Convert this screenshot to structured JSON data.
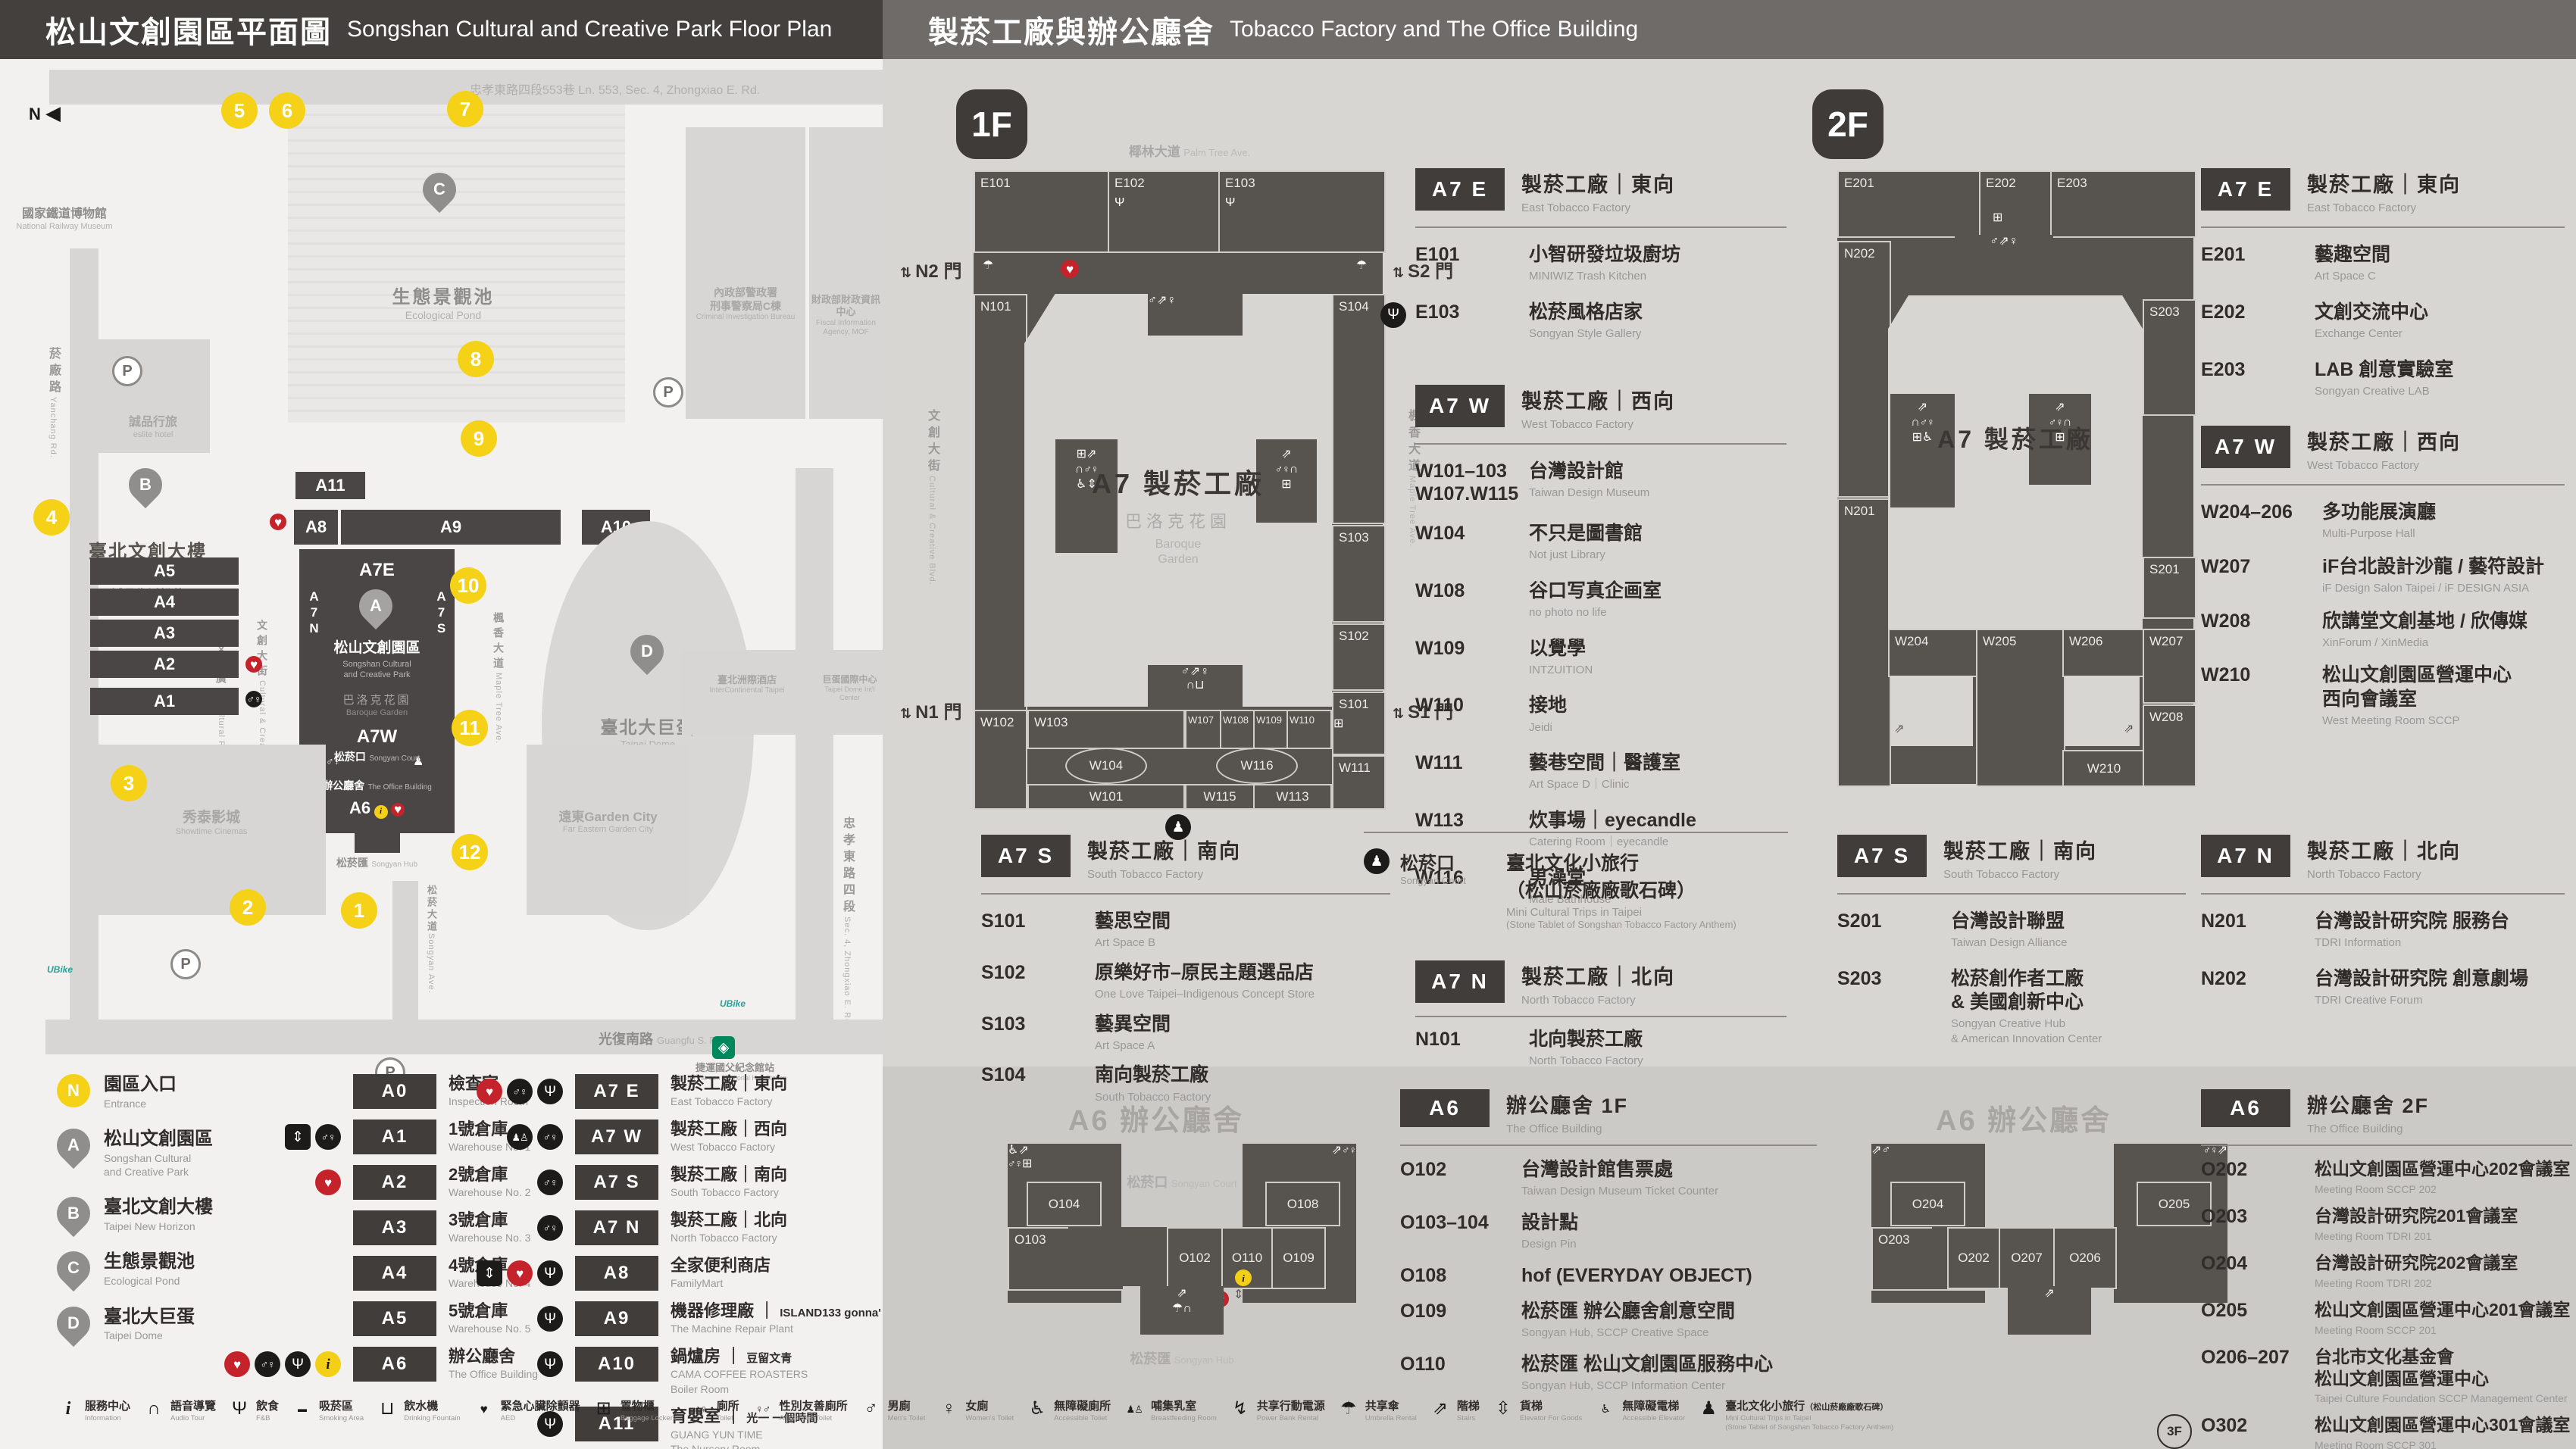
{
  "header": {
    "left_zh": "松山文創園區平面圖",
    "left_en": "Songshan Cultural and Creative Park Floor Plan",
    "right_zh": "製菸工廠與辦公廳舍",
    "right_en": "Tobacco Factory and The Office Building"
  },
  "park": {
    "compass": "N",
    "parking": "P",
    "ubike": "UBike",
    "numbers": [
      "1",
      "2",
      "3",
      "4",
      "5",
      "6",
      "7",
      "8",
      "9",
      "10",
      "11",
      "12"
    ],
    "streets": {
      "top": "忠孝東路四段553巷 Ln. 553, Sec. 4, Zhongxiao E. Rd.",
      "yanchang_zh": "菸廠路",
      "yanchang_en": "Yanchang Rd.",
      "zhongxiao_zh": "忠孝東路四段",
      "zhongxiao_en": "Sec. 4, Zhongxiao E. Rd.",
      "guangfu_zh": "光復南路",
      "guangfu_en": "Guangfu S. Rd.",
      "songyan_zh": "松菸大道",
      "songyan_en": "Songyan Ave.",
      "palm_zh": "椰林大道",
      "palm_en": "Palm Tree Ave.",
      "maple_zh": "楓香大道",
      "maple_en": "Maple Tree Ave.",
      "blvd_zh": "文創大街",
      "blvd_en": "Cultural & Creative Blvd.",
      "plaza_zh": "文化廣場",
      "plaza_en": "Cultural Plaza"
    },
    "landmarks": {
      "railway_zh": "國家鐵道博物館",
      "railway_en": "National Railway Museum",
      "eslite_hotel_zh": "誠品行旅",
      "eslite_hotel_en": "eslite hotel",
      "cib_zh": "內政部警政署",
      "cib_zh2": "刑事警察局C棟",
      "cib_en": "Criminal Investigation Bureau",
      "fia_zh": "財政部財政資訊中心",
      "fia_en": "Fiscal Information Agency, MOF",
      "icc_zh": "臺北洲際酒店",
      "icc_en": "InterContinental Taipei",
      "domeintl_zh": "巨蛋國際中心",
      "domeintl_en": "Taipei Dome Int'l Center",
      "showtime_zh": "秀泰影城",
      "showtime_en": "Showtime Cinemas",
      "garden_zh": "遠東Garden City",
      "garden_en": "Far Eastern Garden City",
      "mrt_zh": "捷運國父紀念館站",
      "mrt_en": "Sun Yat-sen Memorial Hall Station",
      "eslite_spectrum_zh": "誠品生活松菸",
      "eslite_spectrum_en": "eslite Spectrum Songyan",
      "baroque_zh": "巴洛克花園",
      "baroque_en": "Baroque Garden",
      "court_zh": "松菸口",
      "court_en": "Songyan Court",
      "office_zh": "辦公廳舍",
      "office_en": "The Office Building",
      "hub_zh": "松菸匯",
      "hub_en": "Songyan Hub"
    },
    "pins": {
      "a_zh": "松山文創園區",
      "a_en1": "Songshan Cultural",
      "a_en2": "and Creative Park",
      "b_zh": "臺北文創大樓",
      "b_en": "Taipei New Horizon",
      "c_zh": "生態景觀池",
      "c_en": "Ecological Pond",
      "d_zh": "臺北大巨蛋",
      "d_en": "Taipei Dome",
      "a": "A",
      "b": "B",
      "c": "C",
      "d": "D"
    },
    "bars": {
      "a0": "A0",
      "a1": "A1",
      "a2": "A2",
      "a3": "A3",
      "a4": "A4",
      "a5": "A5",
      "a6": "A6",
      "a8": "A8",
      "a9": "A9",
      "a10": "A10",
      "a11": "A11",
      "a7e": "A7E",
      "a7w": "A7W",
      "a7n": "A7N",
      "a7s": "A7S"
    }
  },
  "legend": {
    "pins": [
      {
        "sym": "N",
        "tone": "yellow",
        "zh": "園區入口",
        "en": "Entrance"
      },
      {
        "sym": "A",
        "tone": "gray",
        "zh": "松山文創園區",
        "en": "Songshan Cultural",
        "en2": "and Creative Park"
      },
      {
        "sym": "B",
        "tone": "gray",
        "zh": "臺北文創大樓",
        "en": "Taipei New Horizon"
      },
      {
        "sym": "C",
        "tone": "gray",
        "zh": "生態景觀池",
        "en": "Ecological Pond"
      },
      {
        "sym": "D",
        "tone": "gray",
        "zh": "臺北大巨蛋",
        "en": "Taipei Dome"
      }
    ],
    "col1": [
      {
        "code": "A0",
        "zh": "檢查室",
        "en": "Inspection Room"
      },
      {
        "code": "A1",
        "zh": "1號倉庫",
        "en": "Warehouse No. 1",
        "i1": "elevator",
        "i2": "toilet"
      },
      {
        "code": "A2",
        "zh": "2號倉庫",
        "en": "Warehouse No. 2",
        "i1": "aed"
      },
      {
        "code": "A3",
        "zh": "3號倉庫",
        "en": "Warehouse No. 3"
      },
      {
        "code": "A4",
        "zh": "4號倉庫",
        "en": "Warehouse No. 4"
      },
      {
        "code": "A5",
        "zh": "5號倉庫",
        "en": "Warehouse No. 5"
      },
      {
        "code": "A6",
        "zh": "辦公廳舍",
        "en": "The Office Building",
        "i1": "aed",
        "i2": "toilet",
        "i3": "restaurant",
        "i4": "info"
      }
    ],
    "col2": [
      {
        "code": "A7 E",
        "zh": "製菸工廠｜東向",
        "en": "East Tobacco Factory",
        "i1": "aed",
        "i2": "toilet",
        "i3": "restaurant"
      },
      {
        "code": "A7 W",
        "zh": "製菸工廠｜西向",
        "en": "West Tobacco Factory",
        "i1": "nursing",
        "i2": "toilet"
      },
      {
        "code": "A7 S",
        "zh": "製菸工廠｜南向",
        "en": "South Tobacco Factory",
        "i1": "toilet"
      },
      {
        "code": "A7 N",
        "zh": "製菸工廠｜北向",
        "en": "North Tobacco Factory",
        "i1": "toilet"
      },
      {
        "code": "A8",
        "zh": "全家便利商店",
        "en": "FamilyMart",
        "i1": "elevator",
        "i2": "aed",
        "i3": "restaurant"
      },
      {
        "code": "A9",
        "zh": "機器修理廠",
        "brand": "ISLAND133 gonna'",
        "en": "The Machine Repair Plant",
        "i1": "restaurant"
      },
      {
        "code": "A10",
        "zh": "鍋爐房",
        "brand": "豆留文青",
        "brand_en": "CAMA COFFEE ROASTERS",
        "en": "Boiler Room",
        "i1": "restaurant"
      },
      {
        "code": "A11",
        "zh": "育嬰室",
        "brand": "光一 一個時間",
        "brand_en": "GUANG YUN TIME",
        "en": "The Nursery Room",
        "i1": "restaurant"
      }
    ]
  },
  "icon_legend": [
    {
      "icon": "info",
      "zh": "服務中心",
      "en": "Information"
    },
    {
      "icon": "audio",
      "zh": "語音導覽",
      "en": "Audio Tour"
    },
    {
      "icon": "restaurant",
      "zh": "飲食",
      "en": "F&B"
    },
    {
      "icon": "smoking",
      "zh": "吸菸區",
      "en": "Smoking Area"
    },
    {
      "icon": "drinking",
      "zh": "飲水機",
      "en": "Drinking Fountain"
    },
    {
      "icon": "aed",
      "zh": "緊急心臟除顫器",
      "en": "AED"
    },
    {
      "icon": "locker",
      "zh": "置物櫃",
      "en": "Baggage Lockers"
    },
    {
      "icon": "toilet",
      "zh": "廁所",
      "en": "Toilet"
    },
    {
      "icon": "allgender",
      "zh": "性別友善廁所",
      "en": "All Gender Toilet"
    },
    {
      "icon": "mens",
      "zh": "男廁",
      "en": "Men's Toilet"
    },
    {
      "icon": "womens",
      "zh": "女廁",
      "en": "Women's Toilet"
    },
    {
      "icon": "accessible",
      "zh": "無障礙廁所",
      "en": "Accessible Toilet"
    },
    {
      "icon": "breastfeeding",
      "zh": "哺集乳室",
      "en": "Breastfeeding Room"
    },
    {
      "icon": "powerbank",
      "zh": "共享行動電源",
      "en": "Power Bank Rental"
    },
    {
      "icon": "umbrella",
      "zh": "共享傘",
      "en": "Umbrella Rental"
    },
    {
      "icon": "stairs",
      "zh": "階梯",
      "en": "Stairs"
    },
    {
      "icon": "goods-elevator",
      "zh": "貨梯",
      "en": "Elevator For Goods"
    },
    {
      "icon": "acc-elevator",
      "zh": "無障礙電梯",
      "en": "Accessible Elevator"
    },
    {
      "icon": "pedestrian",
      "zh": "臺北文化小旅行",
      "zh2": "（松山菸廠廠歌石碑）",
      "en": "Mini Cultural Trips in Taipei",
      "en2": "(Stone Tablet of Songshan Tobacco Factory Anthem)"
    }
  ],
  "f1": {
    "badge": "1F",
    "palm_zh": "椰林大道",
    "palm_en": "Palm Tree Ave.",
    "blvd_zh": "文創大街",
    "blvd_en": "Cultural & Creative Blvd.",
    "maple_zh": "楓香大道",
    "maple_en": "Maple Tree Ave.",
    "gates": {
      "n2": "N2 門",
      "n1": "N1 門",
      "s2": "S2 門",
      "s1": "S1 門"
    },
    "center": {
      "title": "A7 製菸工廠",
      "g_zh": "巴洛克花園",
      "g_en1": "Baroque",
      "g_en2": "Garden"
    },
    "rooms": {
      "e101": "E101",
      "e102": "E102",
      "e103": "E103",
      "n101": "N101",
      "s104": "S104",
      "s103": "S103",
      "s102": "S102",
      "s101": "S101",
      "w102": "W102",
      "w103": "W103",
      "w104": "W104",
      "w101": "W101",
      "w107": "W107",
      "w108": "W108",
      "w109": "W109",
      "w110": "W110",
      "w116": "W116",
      "w115": "W115",
      "w113": "W113",
      "w111": "W111"
    },
    "a7e": {
      "badge": "A7 E",
      "zh": "製菸工廠｜東向",
      "en": "East Tobacco Factory",
      "items": [
        {
          "code": "E101",
          "zh": "小智研發垃圾廚坊",
          "en": "MINIWIZ Trash Kitchen"
        },
        {
          "icon": "restaurant",
          "code": "E103",
          "zh": "松菸風格店家",
          "en": "Songyan Style Gallery"
        }
      ]
    },
    "a7w": {
      "badge": "A7 W",
      "zh": "製菸工廠｜西向",
      "en": "West Tobacco Factory",
      "items": [
        {
          "code": "W101–103",
          "code2": "W107.W115",
          "zh": "台灣設計館",
          "en": "Taiwan Design Museum"
        },
        {
          "code": "W104",
          "zh": "不只是圖書館",
          "en": "Not just Library"
        },
        {
          "code": "W108",
          "zh": "谷口写真企画室",
          "en": "no photo no life"
        },
        {
          "code": "W109",
          "zh": "以覺學",
          "en": "INTZUITION"
        },
        {
          "code": "W110",
          "zh": "接地",
          "en": "Jeidi"
        },
        {
          "code": "W111",
          "zh": "藝巷空間｜醫護室",
          "en": "Art Space D｜Clinic"
        },
        {
          "code": "W113",
          "zh": "炊事場｜eyecandle",
          "en": "Catering Room｜eyecandle"
        },
        {
          "code": "W116",
          "zh": "男澡堂",
          "en": "Male Bathhouse"
        }
      ]
    },
    "a7s": {
      "badge": "A7 S",
      "zh": "製菸工廠｜南向",
      "en": "South Tobacco Factory",
      "items": [
        {
          "code": "S101",
          "zh": "藝思空間",
          "en": "Art Space B"
        },
        {
          "code": "S102",
          "zh": "原樂好市–原民主題選品店",
          "en": "One Love Taipei–Indigenous Concept Store"
        },
        {
          "code": "S103",
          "zh": "藝異空間",
          "en": "Art Space A"
        },
        {
          "code": "S104",
          "zh": "南向製菸工廠",
          "en": "South Tobacco Factory"
        }
      ]
    },
    "court": {
      "zh": "松菸口",
      "en": "Songyan Court",
      "name_zh": "臺北文化小旅行",
      "name_zh2": "（松山菸廠廠歌石碑）",
      "name_en": "Mini Cultural Trips in Taipei",
      "name_en2": "(Stone Tablet of Songshan Tobacco Factory Anthem)"
    },
    "a7n": {
      "badge": "A7 N",
      "zh": "製菸工廠｜北向",
      "en": "North Tobacco Factory",
      "items": [
        {
          "code": "N101",
          "zh": "北向製菸工廠",
          "en": "North Tobacco Factory"
        }
      ]
    }
  },
  "f2": {
    "badge": "2F",
    "center": {
      "title": "A7 製菸工廠"
    },
    "rooms": {
      "e201": "E201",
      "e202": "E202",
      "e203": "E203",
      "n202": "N202",
      "n201": "N201",
      "s203": "S203",
      "s201": "S201",
      "w204": "W204",
      "w205": "W205",
      "w206": "W206",
      "w207": "W207",
      "w208": "W208",
      "w210": "W210"
    },
    "a7e": {
      "badge": "A7 E",
      "zh": "製菸工廠｜東向",
      "en": "East Tobacco Factory",
      "items": [
        {
          "code": "E201",
          "zh": "藝趣空間",
          "en": "Art Space C"
        },
        {
          "code": "E202",
          "zh": "文創交流中心",
          "en": "Exchange Center"
        },
        {
          "code": "E203",
          "zh": "LAB 創意實驗室",
          "en": "Songyan Creative LAB"
        }
      ]
    },
    "a7w": {
      "badge": "A7 W",
      "zh": "製菸工廠｜西向",
      "en": "West Tobacco Factory",
      "items": [
        {
          "code": "W204–206",
          "zh": "多功能展演廳",
          "en": "Multi-Purpose Hall"
        },
        {
          "code": "W207",
          "zh": "iF台北設計沙龍 / 藝符設計",
          "en": "iF Design Salon Taipei / iF DESIGN ASIA"
        },
        {
          "code": "W208",
          "zh": "欣講堂文創基地 / 欣傳媒",
          "en": "XinForum / XinMedia"
        },
        {
          "code": "W210",
          "zh": "松山文創園區營運中心",
          "zh2": "西向會議室",
          "en": "West Meeting Room SCCP"
        }
      ]
    },
    "a7s": {
      "badge": "A7 S",
      "zh": "製菸工廠｜南向",
      "en": "South Tobacco Factory",
      "items": [
        {
          "code": "S201",
          "zh": "台灣設計聯盟",
          "en": "Taiwan Design Alliance"
        },
        {
          "code": "S203",
          "zh": "松菸創作者工廠",
          "zh2": "& 美國創新中心",
          "en": "Songyan Creative Hub",
          "en2": "& American Innovation Center"
        }
      ]
    },
    "a7n": {
      "badge": "A7 N",
      "zh": "製菸工廠｜北向",
      "en": "North Tobacco Factory",
      "items": [
        {
          "code": "N201",
          "zh": "台灣設計研究院 服務台",
          "en": "TDRI Information"
        },
        {
          "code": "N202",
          "zh": "台灣設計研究院 創意劇場",
          "en": "TDRI Creative Forum"
        }
      ]
    }
  },
  "a6f1": {
    "badge": "A6",
    "t_zh": "辦公廳舍 1F",
    "t_en": "The Office Building",
    "map_title": "A6 辦公廳舍",
    "court_zh": "松菸口",
    "court_en": "Songyan Court",
    "hub_zh": "松菸匯",
    "hub_en": "Songyan Hub",
    "rooms": {
      "o104": "O104",
      "o103": "O103",
      "o102": "O102",
      "o110": "O110",
      "o109": "O109",
      "o108": "O108"
    },
    "items": [
      {
        "code": "O102",
        "zh": "台灣設計館售票處",
        "en": "Taiwan Design Museum Ticket Counter"
      },
      {
        "code": "O103–104",
        "zh": "設計點",
        "en": "Design Pin"
      },
      {
        "code": "O108",
        "zh": "hof (EVERYDAY OBJECT)"
      },
      {
        "code": "O109",
        "zh": "松菸匯 辦公廳舍創意空間",
        "en": "Songyan Hub, SCCP Creative Space"
      },
      {
        "code": "O110",
        "zh": "松菸匯 松山文創園區服務中心",
        "en": "Songyan Hub, SCCP Information Center"
      }
    ]
  },
  "a6f2": {
    "badge": "A6",
    "t_zh": "辦公廳舍 2F",
    "t_en": "The Office Building",
    "map_title": "A6 辦公廳舍",
    "rooms": {
      "o204": "O204",
      "o203": "O203",
      "o202": "O202",
      "o207": "O207",
      "o206": "O206",
      "o205": "O205"
    },
    "items": [
      {
        "code": "O202",
        "zh": "松山文創園區營運中心202會議室",
        "en": "Meeting Room SCCP 202"
      },
      {
        "code": "O203",
        "zh": "台灣設計研究院201會議室",
        "en": "Meeting Room TDRI 201"
      },
      {
        "code": "O204",
        "zh": "台灣設計研究院202會議室",
        "en": "Meeting Room TDRI 202"
      },
      {
        "code": "O205",
        "zh": "松山文創園區營運中心201會議室",
        "en": "Meeting Room SCCP 201"
      },
      {
        "code": "O206–207",
        "zh": "台北市文化基金會",
        "zh2": "松山文創園區營運中心",
        "en": "Taipei Culture Foundation SCCP Management Center"
      },
      {
        "pre": "3F",
        "code": "O302",
        "zh": "松山文創園區營運中心301會議室",
        "en": "Meeting Room SCCP 301"
      }
    ]
  }
}
